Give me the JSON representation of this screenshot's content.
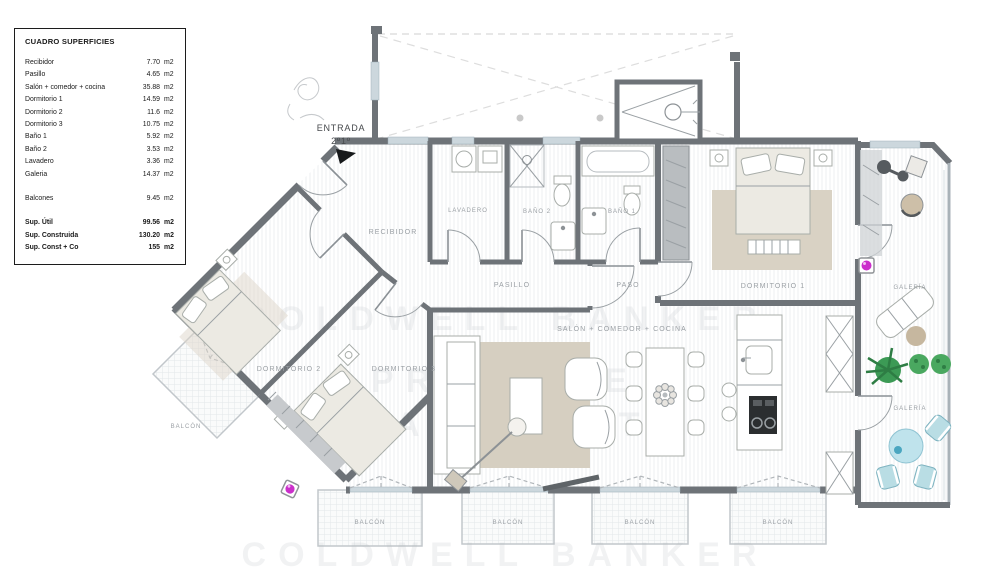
{
  "surface_table": {
    "title": "CUADRO SUPERFICIES",
    "rows": [
      {
        "label": "Recibidor",
        "value": "7.70",
        "unit": "m2"
      },
      {
        "label": "Pasillo",
        "value": "4.65",
        "unit": "m2"
      },
      {
        "label": "Salón + comedor + cocina",
        "value": "35.88",
        "unit": "m2"
      },
      {
        "label": "Dormitorio 1",
        "value": "14.59",
        "unit": "m2"
      },
      {
        "label": "Dormitorio 2",
        "value": "11.6",
        "unit": "m2"
      },
      {
        "label": "Dormitorio 3",
        "value": "10.75",
        "unit": "m2"
      },
      {
        "label": "Baño 1",
        "value": "5.92",
        "unit": "m2"
      },
      {
        "label": "Baño 2",
        "value": "3.53",
        "unit": "m2"
      },
      {
        "label": "Lavadero",
        "value": "3.36",
        "unit": "m2"
      },
      {
        "label": "Galeria",
        "value": "14.37",
        "unit": "m2"
      }
    ],
    "balcones_row": {
      "label": "Balcones",
      "value": "9.45",
      "unit": "m2"
    },
    "totals": [
      {
        "label": "Sup. Útil",
        "value": "99.56",
        "unit": "m2"
      },
      {
        "label": "Sup. Construida",
        "value": "130.20",
        "unit": "m2"
      },
      {
        "label": "Sup. Const + Co",
        "value": "155",
        "unit": "m2"
      }
    ]
  },
  "plan": {
    "entrada_line1": "ENTRADA",
    "entrada_line2": "2º1º",
    "recibidor": "RECIBIDOR",
    "lavadero": "LAVADERO",
    "bano2": "BAÑO 2",
    "bano1": "BAÑO 1",
    "pasillo": "PASILLO",
    "paso": "PASO",
    "dormitorio1": "DORMITORIO 1",
    "dormitorio2": "DORMITORIO 2",
    "dormitorio3": "DORMITORIO 3",
    "salon": "SALÓN + COMEDOR + COCINA",
    "galeria": "GALERÍA",
    "balcon": "BALCÓN"
  },
  "watermark": {
    "line1": "COLDWELL BANKER",
    "line2": "PRESTIGE",
    "line3": "REAL ESTATE"
  },
  "colors": {
    "wall_gray": "#6e7378",
    "label_gray": "#9ba0a5",
    "accent_magenta": "#cb2fcb",
    "plant_green": "#3c9a55",
    "water_blue": "#bfe3ec",
    "rug_beige": "#d9d2c4",
    "sill_blue": "#ccd7dd"
  }
}
